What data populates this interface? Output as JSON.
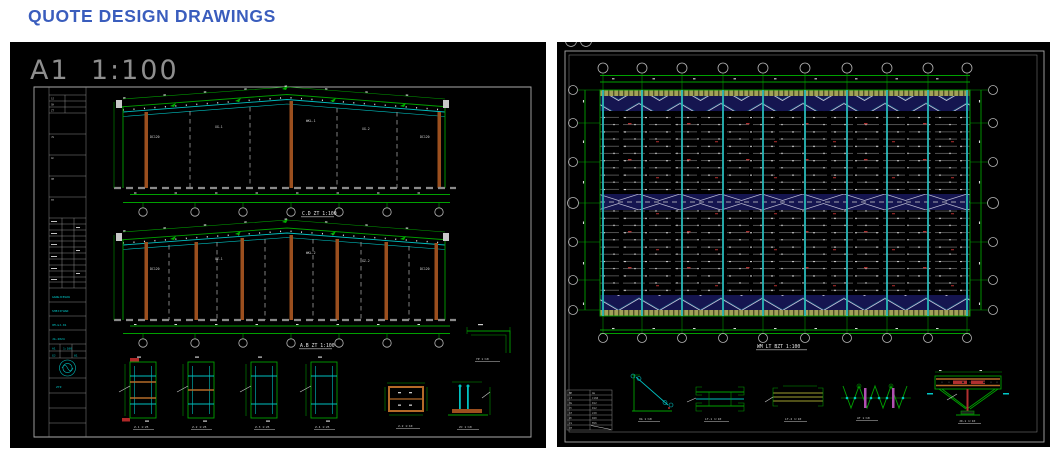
{
  "header": {
    "title": "QUOTE DESIGN DRAWINGS"
  },
  "colors": {
    "accent_blue": "#3a5dbd",
    "panel_bg": "#000000",
    "cad_green": "#00a000",
    "cad_cyan": "#00bfbf",
    "cad_brown": "#9b4f1e",
    "cad_khaki": "#a2a258",
    "cad_navy": "#151550",
    "cad_red": "#b03030",
    "cad_magenta": "#b050b0"
  },
  "left_sheet": {
    "format_label": "A1  1:100",
    "elevations": [
      {
        "title": "C.D ZT 1:100",
        "labels": [
          "DC120",
          "XG-1",
          "WKL-1",
          "XG-2",
          "DC120"
        ]
      },
      {
        "title": "A.B ZT 1:100",
        "labels": [
          "DC120",
          "GZ-1",
          "WKL-2",
          "GZ-2",
          "DC120"
        ]
      }
    ],
    "sections": [
      {
        "label": "Z-1 1:25"
      },
      {
        "label": "Z-2 1:25"
      },
      {
        "label": "Z-3 1:25"
      },
      {
        "label": "Z-4 1:25"
      }
    ],
    "details": {
      "canopy": "YP 1:10",
      "beam_box": "2-2 1:10",
      "col_base": "ZJ 1:10"
    },
    "titleblock": {
      "header_rows": [
        "SJ",
        "SH",
        "ZT"
      ],
      "box_labels": [
        "JS",
        "GC",
        "XM",
        "TH"
      ],
      "entries": [
        "GANGJIEGOU",
        "SHEJIYUAN",
        "XM-GJ-01",
        "JG-2024"
      ],
      "cells": [
        "A1",
        "1:100",
        "GJ",
        "01"
      ],
      "stamp": "ZYZ"
    }
  },
  "right_sheet": {
    "plan_title": "WM LT BZT 1:100",
    "schedule": {
      "headers": [
        "BH",
        "GG"
      ],
      "rows": [
        [
          "LT",
          "C160"
        ],
        [
          "XG",
          "D12"
        ],
        [
          "YC",
          "D12"
        ],
        [
          "AT",
          "L50"
        ],
        [
          "ZC",
          "D20"
        ],
        [
          "LS",
          "M16"
        ],
        [
          "QT",
          ""
        ]
      ]
    },
    "details": [
      {
        "label": "XG 1:10"
      },
      {
        "label": "LT-1 1:10"
      },
      {
        "label": "LT-2 1:10"
      },
      {
        "label": "AT 1:10"
      },
      {
        "label": "JD-1 1:10"
      }
    ]
  }
}
